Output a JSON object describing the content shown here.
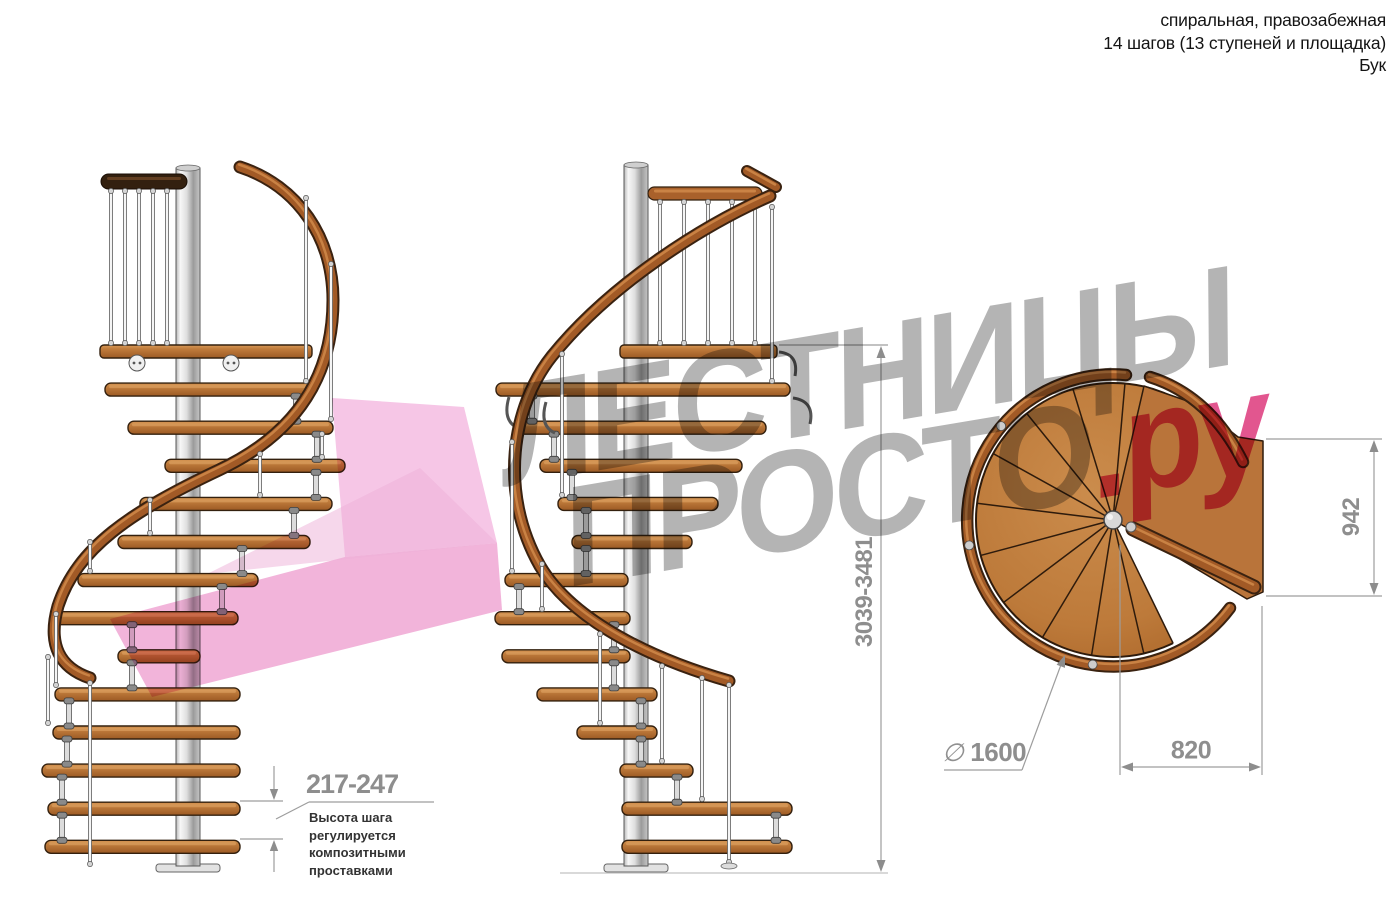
{
  "header": {
    "lines": [
      "спиральная, правозабежная",
      "14 шагов (13 ступеней и площадка)",
      "Бук"
    ]
  },
  "watermark": {
    "line1": "ЛЕСТНИЦЫ",
    "line2_gray": "ПРОСТО",
    "line2_pink": ".ру"
  },
  "dimensions": {
    "total_height": "3039-3481",
    "landing_width": "942",
    "step_width": "820",
    "diameter_symbol": "∅",
    "diameter_value": "1600",
    "step_height": "217-247",
    "step_height_note_lines": [
      "Высота шага",
      "регулируется",
      "композитными",
      "проставками"
    ]
  },
  "colors": {
    "wood": "#b97438",
    "handrail": "#a25a26",
    "dark_rail": "#33200f",
    "metal_pole": "#d9d9d9",
    "watermark_gray": "#b4b4b4",
    "watermark_pink": "#e2568f",
    "arrow_pink": "#f2b4da",
    "dimension_gray": "#8e8e8e"
  }
}
